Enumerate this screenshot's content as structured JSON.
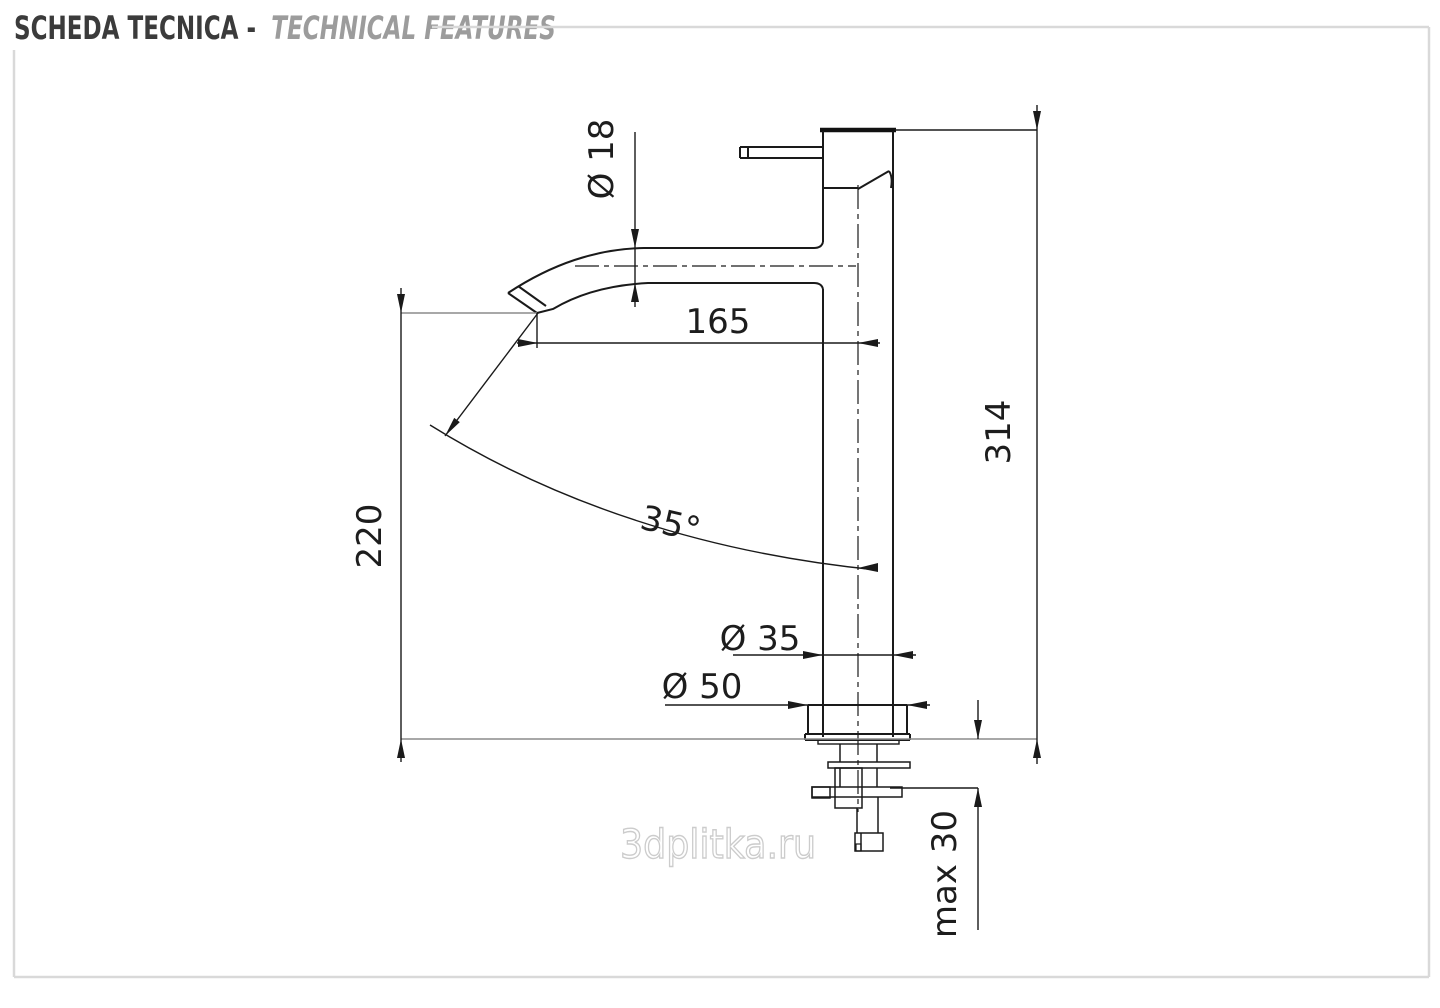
{
  "header": {
    "title_primary": "SCHEDA TECNICA -",
    "title_secondary": "TECHNICAL FEATURES"
  },
  "drawing": {
    "type": "technical-drawing",
    "subject": "tall single-lever basin mixer tap, side elevation with installation dimensions (mm)",
    "dimensions": {
      "spout_diameter": "Ø 18",
      "spout_reach": "165",
      "spout_height": "220",
      "total_height": "314",
      "spout_angle": "35°",
      "body_diameter": "Ø 35",
      "base_diameter": "Ø 50",
      "deck_thickness": "max 30"
    },
    "colors": {
      "line": "#1a1a1a",
      "reference_line": "#8c8c8c",
      "frame": "#d9d9d9",
      "header_primary": "#3b3b3b",
      "header_secondary": "#9c9c9c",
      "watermark": "#cccccc"
    }
  },
  "watermark": {
    "text": "3dplitka.ru"
  }
}
